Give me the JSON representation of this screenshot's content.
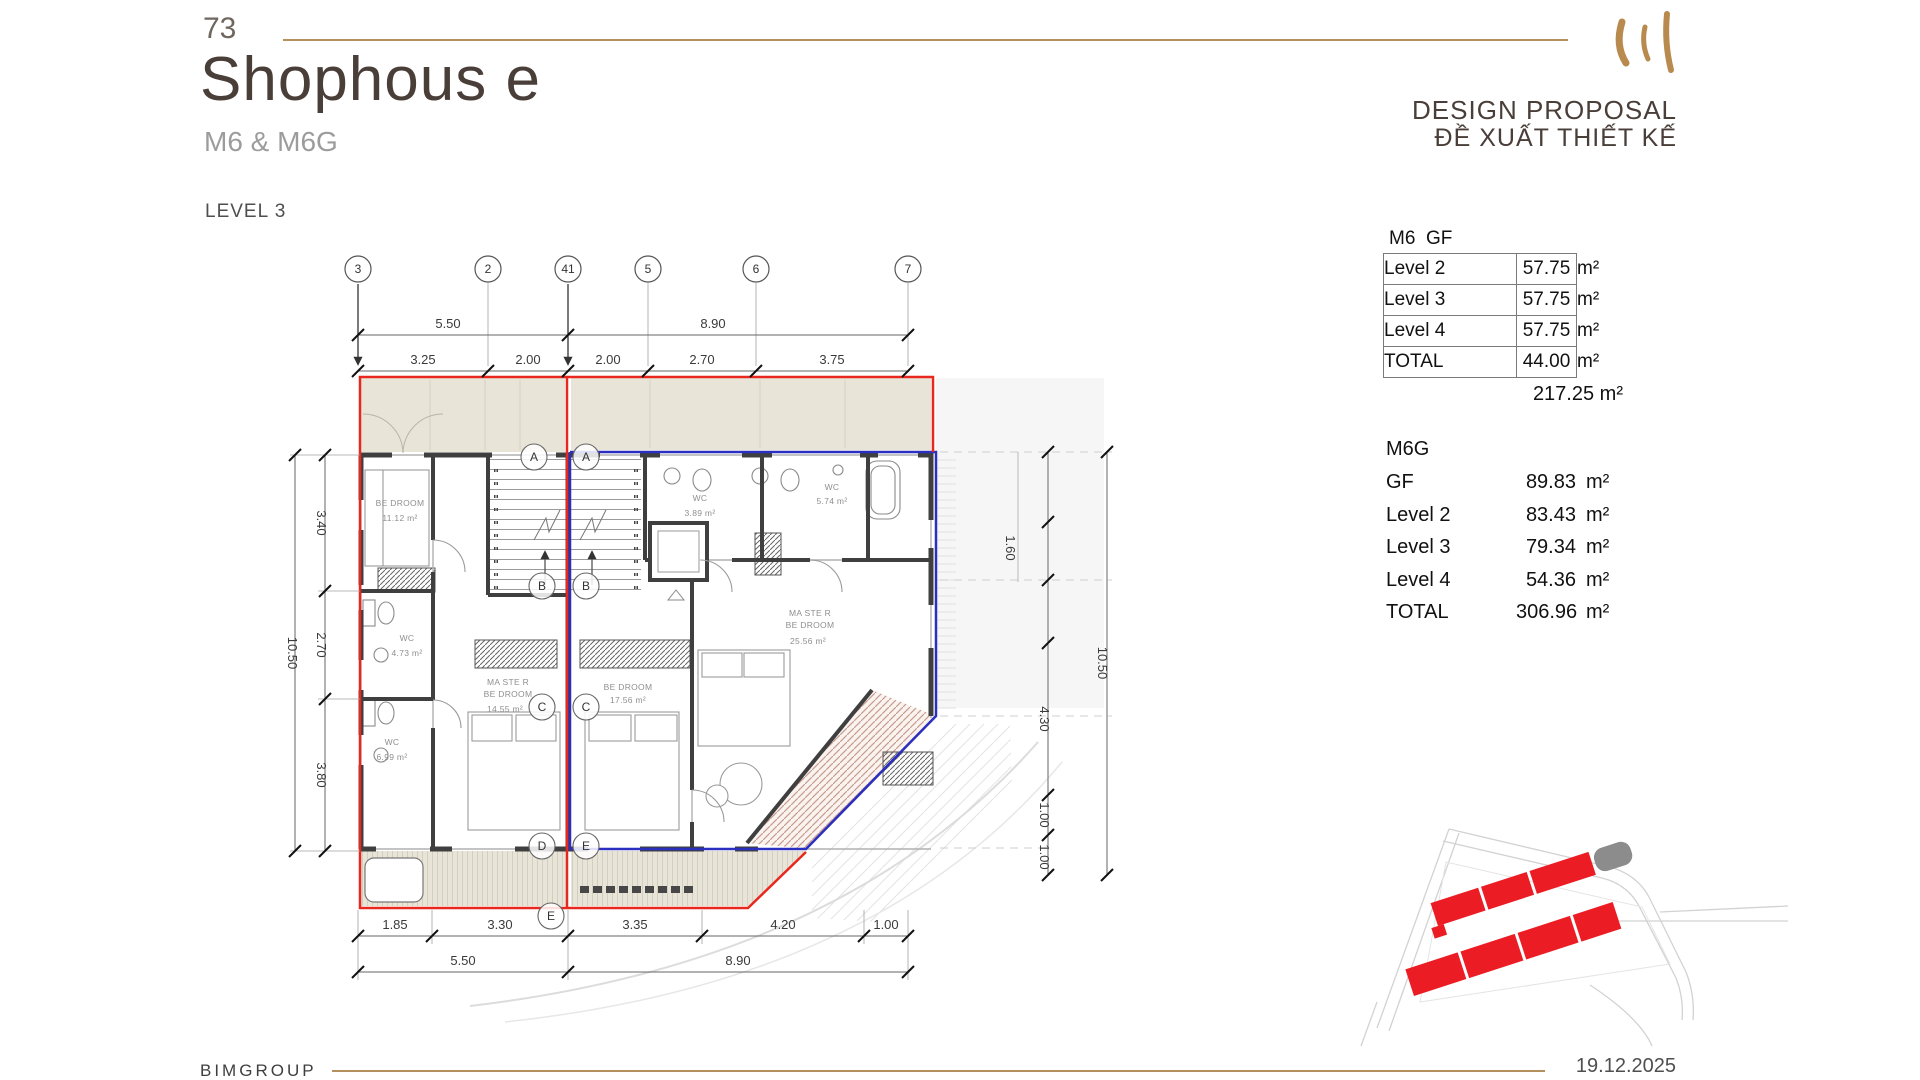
{
  "header": {
    "number": "73",
    "title": "Shophous e",
    "subtitle": "M6 & M6G",
    "level": "LEVEL 3",
    "proposal_en": "DESIGN PROPOSAL",
    "proposal_vi": "ĐỀ XUẤT THIẾT KẾ"
  },
  "tables": {
    "m6": {
      "title": "M6  GF",
      "rows": [
        {
          "label": "Level 2",
          "value": "57.75",
          "unit": "m²"
        },
        {
          "label": "Level 3",
          "value": "57.75",
          "unit": "m²"
        },
        {
          "label": "Level 4",
          "value": "57.75",
          "unit": "m²"
        },
        {
          "label": "TOTAL",
          "value": "44.00",
          "unit": "m²"
        }
      ],
      "grand_total": "217.25 m²"
    },
    "m6g": {
      "title": "M6G",
      "rows": [
        {
          "label": "GF",
          "value": "89.83",
          "unit": "m²"
        },
        {
          "label": "Level 2",
          "value": "83.43",
          "unit": "m²"
        },
        {
          "label": "Level 3",
          "value": "79.34",
          "unit": "m²"
        },
        {
          "label": "Level 4",
          "value": "54.36",
          "unit": "m²"
        },
        {
          "label": "TOTAL",
          "value": "306.96",
          "unit": "m²"
        }
      ]
    }
  },
  "plan": {
    "bubbles_top": [
      "3",
      "2",
      "41",
      "5",
      "6",
      "7"
    ],
    "bubbles_rows": [
      "A",
      "A",
      "B",
      "B",
      "C",
      "C",
      "D",
      "E",
      "E"
    ],
    "dims": {
      "top_row1": [
        "5.50",
        "8.90"
      ],
      "top_row2": [
        "3.25",
        "2.00",
        "2.00",
        "2.70",
        "3.75"
      ],
      "bottom_row1": [
        "1.85",
        "3.30",
        "3.35",
        "4.20",
        "1.00"
      ],
      "bottom_row2": [
        "5.50",
        "8.90"
      ],
      "left_inner": [
        "3.40",
        "2.70",
        "3.80"
      ],
      "left_outer": "10.50",
      "right_items": [
        "1.60",
        "10.50",
        "4.30",
        "1.00",
        "1.00"
      ]
    },
    "rooms": [
      {
        "line1": "BE DROOM",
        "area": "11.12 m²"
      },
      {
        "line1": "WC",
        "area": "4.73 m²"
      },
      {
        "line1": "WC",
        "area": "6.99 m²"
      },
      {
        "line1": "MA STE R",
        "line2": "BE DROOM",
        "area": "14.55 m²"
      },
      {
        "line1": "WC",
        "area": "3.89 m²"
      },
      {
        "line1": "WC",
        "area": "5.74 m²"
      },
      {
        "line1": "BE DROOM",
        "area": "17.56 m²"
      },
      {
        "line1": "MA STE R",
        "line2": "BE DROOM",
        "area": "25.56 m²"
      }
    ]
  },
  "footer": {
    "company": "BIMGROUP",
    "date": "19.12.2025"
  },
  "colors": {
    "accent_gold": "#b5905f",
    "lot_red": "#e8281e",
    "unit_blue": "#2b2fc0",
    "wall_dark": "#3f3f3f",
    "balcony_beige": "#e8e5d8",
    "site_building_red": "#ec1c24"
  }
}
